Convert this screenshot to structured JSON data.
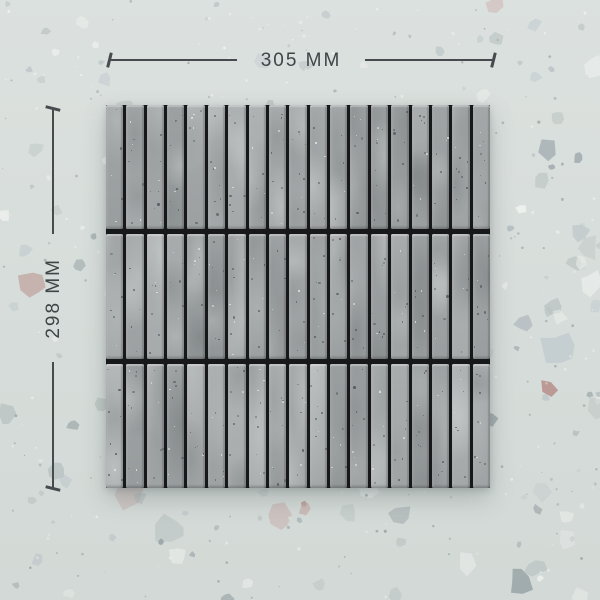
{
  "product": {
    "type": "grey kit-kat finger mosaic tile sheet on terrazzo surface",
    "rows": 3,
    "strips_per_row": 19
  },
  "dimensions": {
    "width_label": "305 MM",
    "height_label": "298 MM"
  },
  "colors": {
    "background_base": "#d9dfdc",
    "chip_palette": [
      "#c3cccf",
      "#b3bcc0",
      "#a2acb0",
      "#edf0ee",
      "#f6f7f5",
      "#96a1a5",
      "#c9aeab",
      "#b3827d",
      "#bcc5c3"
    ],
    "strip_base": "#a9acad",
    "grout": "#17181a",
    "dimension_line": "#474b4e",
    "dimension_text": "#3f4447"
  }
}
